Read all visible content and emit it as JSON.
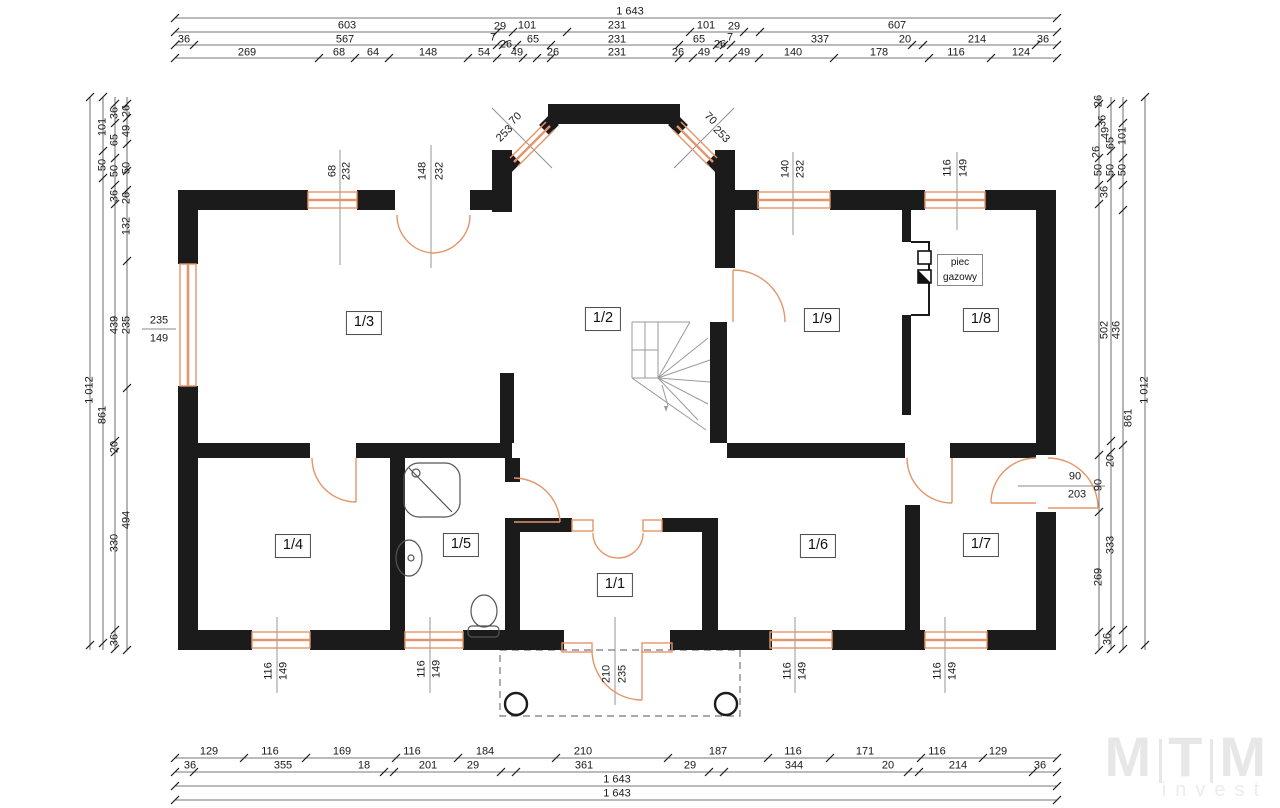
{
  "colors": {
    "wall": "#1b1b1b",
    "joinery": "#e5956a",
    "dim_line": "#4a4a4a",
    "stairs": "#9a9a9a",
    "logo": "#e7e7e7"
  },
  "boiler": {
    "line1": "piec",
    "line2": "gazowy"
  },
  "logo": {
    "part1": "M",
    "part2": "T",
    "part3": "M",
    "sub": "invest"
  },
  "rooms": [
    {
      "label": "1/3",
      "x": 364,
      "y": 323
    },
    {
      "label": "1/2",
      "x": 603,
      "y": 319
    },
    {
      "label": "1/9",
      "x": 822,
      "y": 320
    },
    {
      "label": "1/8",
      "x": 981,
      "y": 320
    },
    {
      "label": "1/4",
      "x": 293,
      "y": 546
    },
    {
      "label": "1/5",
      "x": 461,
      "y": 545
    },
    {
      "label": "1/1",
      "x": 615,
      "y": 585
    },
    {
      "label": "1/6",
      "x": 818,
      "y": 546
    },
    {
      "label": "1/7",
      "x": 981,
      "y": 545
    }
  ],
  "dim_labels": [
    {
      "t": "1 643",
      "x": 630,
      "y": 12,
      "r": 0
    },
    {
      "t": "603",
      "x": 347,
      "y": 26,
      "r": 0
    },
    {
      "t": "29",
      "x": 500,
      "y": 27,
      "r": 0
    },
    {
      "t": "101",
      "x": 527,
      "y": 26,
      "r": 0
    },
    {
      "t": "231",
      "x": 617,
      "y": 26,
      "r": 0
    },
    {
      "t": "101",
      "x": 706,
      "y": 26,
      "r": 0
    },
    {
      "t": "29",
      "x": 734,
      "y": 27,
      "r": 0
    },
    {
      "t": "607",
      "x": 897,
      "y": 26,
      "r": 0
    },
    {
      "t": "36",
      "x": 184,
      "y": 40,
      "r": 0
    },
    {
      "t": "567",
      "x": 345,
      "y": 40,
      "r": 0
    },
    {
      "t": "7",
      "x": 493,
      "y": 38,
      "r": 0
    },
    {
      "t": "26",
      "x": 506,
      "y": 45,
      "r": 0
    },
    {
      "t": "65",
      "x": 533,
      "y": 40,
      "r": 0
    },
    {
      "t": "231",
      "x": 617,
      "y": 40,
      "r": 0
    },
    {
      "t": "65",
      "x": 699,
      "y": 40,
      "r": 0
    },
    {
      "t": "26",
      "x": 720,
      "y": 45,
      "r": 0
    },
    {
      "t": "7",
      "x": 730,
      "y": 38,
      "r": 0
    },
    {
      "t": "337",
      "x": 820,
      "y": 40,
      "r": 0
    },
    {
      "t": "20",
      "x": 905,
      "y": 40,
      "r": 0
    },
    {
      "t": "214",
      "x": 977,
      "y": 40,
      "r": 0
    },
    {
      "t": "36",
      "x": 1043,
      "y": 40,
      "r": 0
    },
    {
      "t": "269",
      "x": 247,
      "y": 53,
      "r": 0
    },
    {
      "t": "68",
      "x": 339,
      "y": 53,
      "r": 0
    },
    {
      "t": "64",
      "x": 373,
      "y": 53,
      "r": 0
    },
    {
      "t": "148",
      "x": 428,
      "y": 53,
      "r": 0
    },
    {
      "t": "54",
      "x": 484,
      "y": 53,
      "r": 0
    },
    {
      "t": "49",
      "x": 517,
      "y": 53,
      "r": 0
    },
    {
      "t": "26",
      "x": 553,
      "y": 53,
      "r": 0
    },
    {
      "t": "231",
      "x": 617,
      "y": 53,
      "r": 0
    },
    {
      "t": "26",
      "x": 678,
      "y": 53,
      "r": 0
    },
    {
      "t": "49",
      "x": 704,
      "y": 53,
      "r": 0
    },
    {
      "t": "49",
      "x": 744,
      "y": 53,
      "r": 0
    },
    {
      "t": "140",
      "x": 793,
      "y": 53,
      "r": 0
    },
    {
      "t": "178",
      "x": 879,
      "y": 53,
      "r": 0
    },
    {
      "t": "116",
      "x": 956,
      "y": 53,
      "r": 0
    },
    {
      "t": "124",
      "x": 1021,
      "y": 53,
      "r": 0
    },
    {
      "t": "129",
      "x": 209,
      "y": 752,
      "r": 0
    },
    {
      "t": "116",
      "x": 270,
      "y": 752,
      "r": 0
    },
    {
      "t": "169",
      "x": 342,
      "y": 752,
      "r": 0
    },
    {
      "t": "116",
      "x": 412,
      "y": 752,
      "r": 0
    },
    {
      "t": "184",
      "x": 485,
      "y": 752,
      "r": 0
    },
    {
      "t": "210",
      "x": 583,
      "y": 752,
      "r": 0
    },
    {
      "t": "187",
      "x": 718,
      "y": 752,
      "r": 0
    },
    {
      "t": "116",
      "x": 793,
      "y": 752,
      "r": 0
    },
    {
      "t": "171",
      "x": 865,
      "y": 752,
      "r": 0
    },
    {
      "t": "116",
      "x": 937,
      "y": 752,
      "r": 0
    },
    {
      "t": "129",
      "x": 998,
      "y": 752,
      "r": 0
    },
    {
      "t": "36",
      "x": 190,
      "y": 766,
      "r": 0
    },
    {
      "t": "355",
      "x": 283,
      "y": 766,
      "r": 0
    },
    {
      "t": "18",
      "x": 364,
      "y": 766,
      "r": 0
    },
    {
      "t": "201",
      "x": 428,
      "y": 766,
      "r": 0
    },
    {
      "t": "29",
      "x": 473,
      "y": 766,
      "r": 0
    },
    {
      "t": "361",
      "x": 584,
      "y": 766,
      "r": 0
    },
    {
      "t": "29",
      "x": 690,
      "y": 766,
      "r": 0
    },
    {
      "t": "344",
      "x": 794,
      "y": 766,
      "r": 0
    },
    {
      "t": "20",
      "x": 888,
      "y": 766,
      "r": 0
    },
    {
      "t": "214",
      "x": 958,
      "y": 766,
      "r": 0
    },
    {
      "t": "36",
      "x": 1040,
      "y": 766,
      "r": 0
    },
    {
      "t": "1 643",
      "x": 617,
      "y": 780,
      "r": 0
    },
    {
      "t": "1 643",
      "x": 617,
      "y": 794,
      "r": 0
    },
    {
      "t": "1 012",
      "x": 90,
      "y": 390,
      "r": -90
    },
    {
      "t": "101",
      "x": 103,
      "y": 127,
      "r": -90
    },
    {
      "t": "50",
      "x": 103,
      "y": 165,
      "r": -90
    },
    {
      "t": "861",
      "x": 103,
      "y": 415,
      "r": -90
    },
    {
      "t": "36",
      "x": 115,
      "y": 113,
      "r": -90
    },
    {
      "t": "65",
      "x": 115,
      "y": 140,
      "r": -90
    },
    {
      "t": "50",
      "x": 115,
      "y": 171,
      "r": -90
    },
    {
      "t": "36",
      "x": 115,
      "y": 196,
      "r": -90
    },
    {
      "t": "439",
      "x": 115,
      "y": 325,
      "r": -90
    },
    {
      "t": "20",
      "x": 115,
      "y": 447,
      "r": -90
    },
    {
      "t": "330",
      "x": 115,
      "y": 543,
      "r": -90
    },
    {
      "t": "36",
      "x": 115,
      "y": 640,
      "r": -90
    },
    {
      "t": "26",
      "x": 127,
      "y": 111,
      "r": -90
    },
    {
      "t": "49",
      "x": 127,
      "y": 131,
      "r": -90
    },
    {
      "t": "50",
      "x": 127,
      "y": 168,
      "r": -90
    },
    {
      "t": "26",
      "x": 127,
      "y": 198,
      "r": -90
    },
    {
      "t": "132",
      "x": 127,
      "y": 226,
      "r": -90
    },
    {
      "t": "235",
      "x": 127,
      "y": 325,
      "r": -90
    },
    {
      "t": "494",
      "x": 127,
      "y": 520,
      "r": -90
    },
    {
      "t": "235",
      "x": 159,
      "y": 321,
      "r": 0
    },
    {
      "t": "149",
      "x": 159,
      "y": 339,
      "r": 0
    },
    {
      "t": "26",
      "x": 1099,
      "y": 101,
      "r": -90
    },
    {
      "t": "36",
      "x": 1103,
      "y": 121,
      "r": -90
    },
    {
      "t": "49",
      "x": 1106,
      "y": 133,
      "r": -90
    },
    {
      "t": "101",
      "x": 1123,
      "y": 136,
      "r": -90
    },
    {
      "t": "65",
      "x": 1111,
      "y": 143,
      "r": -90
    },
    {
      "t": "26",
      "x": 1097,
      "y": 152,
      "r": -90
    },
    {
      "t": "50",
      "x": 1099,
      "y": 170,
      "r": -90
    },
    {
      "t": "50",
      "x": 1111,
      "y": 170,
      "r": -90
    },
    {
      "t": "50",
      "x": 1123,
      "y": 170,
      "r": -90
    },
    {
      "t": "36",
      "x": 1105,
      "y": 192,
      "r": -90
    },
    {
      "t": "502",
      "x": 1105,
      "y": 330,
      "r": -90
    },
    {
      "t": "436",
      "x": 1117,
      "y": 330,
      "r": -90
    },
    {
      "t": "1 012",
      "x": 1145,
      "y": 390,
      "r": -90
    },
    {
      "t": "861",
      "x": 1129,
      "y": 418,
      "r": -90
    },
    {
      "t": "20",
      "x": 1111,
      "y": 461,
      "r": -90
    },
    {
      "t": "90",
      "x": 1099,
      "y": 485,
      "r": -90
    },
    {
      "t": "333",
      "x": 1111,
      "y": 545,
      "r": -90
    },
    {
      "t": "269",
      "x": 1099,
      "y": 577,
      "r": -90
    },
    {
      "t": "36",
      "x": 1108,
      "y": 639,
      "r": -90
    },
    {
      "t": "90",
      "x": 1075,
      "y": 477,
      "r": 0
    },
    {
      "t": "203",
      "x": 1077,
      "y": 495,
      "r": 0
    },
    {
      "t": "68",
      "x": 333,
      "y": 171,
      "r": -90
    },
    {
      "t": "232",
      "x": 347,
      "y": 171,
      "r": -90
    },
    {
      "t": "148",
      "x": 423,
      "y": 171,
      "r": -90
    },
    {
      "t": "232",
      "x": 440,
      "y": 171,
      "r": -90
    },
    {
      "t": "140",
      "x": 786,
      "y": 169,
      "r": -90
    },
    {
      "t": "232",
      "x": 801,
      "y": 169,
      "r": -90
    },
    {
      "t": "116",
      "x": 948,
      "y": 168,
      "r": -90
    },
    {
      "t": "149",
      "x": 964,
      "y": 168,
      "r": -90
    },
    {
      "t": "116",
      "x": 269,
      "y": 671,
      "r": -90
    },
    {
      "t": "149",
      "x": 284,
      "y": 671,
      "r": -90
    },
    {
      "t": "116",
      "x": 422,
      "y": 669,
      "r": -90
    },
    {
      "t": "149",
      "x": 437,
      "y": 669,
      "r": -90
    },
    {
      "t": "116",
      "x": 788,
      "y": 671,
      "r": -90
    },
    {
      "t": "149",
      "x": 803,
      "y": 671,
      "r": -90
    },
    {
      "t": "116",
      "x": 938,
      "y": 671,
      "r": -90
    },
    {
      "t": "149",
      "x": 953,
      "y": 671,
      "r": -90
    },
    {
      "t": "210",
      "x": 607,
      "y": 674,
      "r": -90
    },
    {
      "t": "235",
      "x": 623,
      "y": 674,
      "r": -90
    },
    {
      "t": "70",
      "x": 516,
      "y": 119,
      "r": -45
    },
    {
      "t": "253",
      "x": 505,
      "y": 134,
      "r": -45
    },
    {
      "t": "70",
      "x": 710,
      "y": 119,
      "r": 45
    },
    {
      "t": "253",
      "x": 721,
      "y": 135,
      "r": 45
    }
  ]
}
